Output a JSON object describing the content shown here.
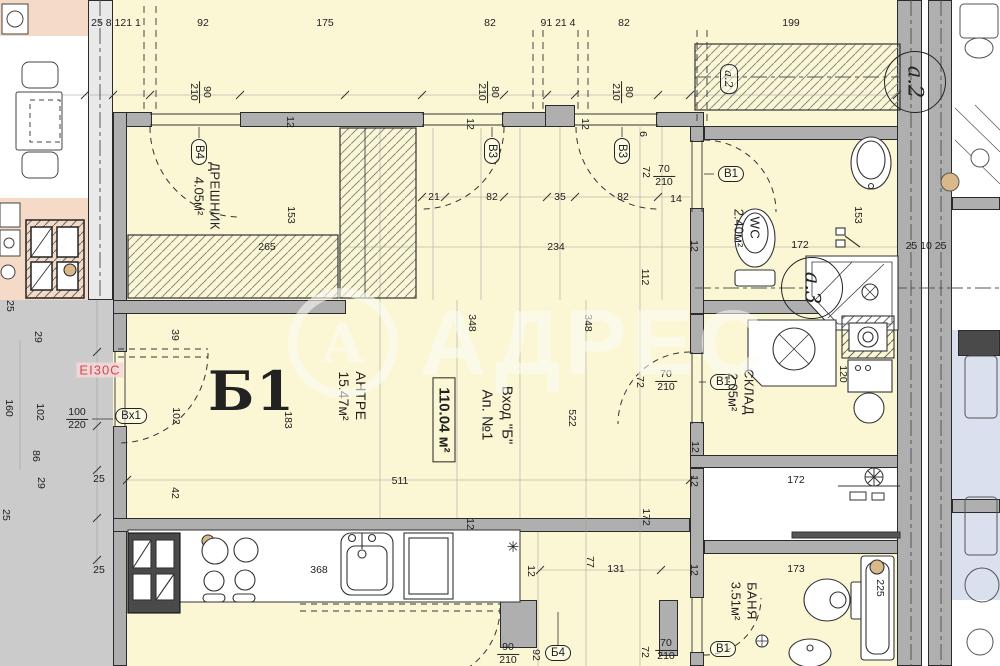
{
  "unit": {
    "label": "Б1",
    "area_box": "110.04 м²",
    "entrance_l1": "Вход \"Б\"",
    "entrance_l2": "Ап. №1"
  },
  "fire_door_label": "EI30C",
  "watermark": {
    "text": "АДРЕС",
    "logo": "А"
  },
  "colors": {
    "floor_cream": "#FBF7D5",
    "wall_gray": "#AFAFAF",
    "corridor_gray": "#CBCBCB",
    "neighbor_pink": "#F5DAC8",
    "neighbor_blue": "#DBE0EE",
    "fire_red": "#C94F4F",
    "watermark": "rgba(252,252,246,0.58)"
  },
  "rooms": [
    {
      "name": "ДРЕШНИК",
      "area": "4.05м²",
      "x": 207,
      "y": 196,
      "fs": 13
    },
    {
      "name": "АНТРЕ",
      "area": "15.47м²",
      "x": 352,
      "y": 396,
      "fs": 14
    },
    {
      "name": "WC",
      "area": "2.40м²",
      "x": 747,
      "y": 228,
      "fs": 13
    },
    {
      "name": "СКЛАД",
      "area": "2.05м²",
      "x": 741,
      "y": 392,
      "fs": 13
    },
    {
      "name": "БАНЯ",
      "area": "3.51м²",
      "x": 744,
      "y": 601,
      "fs": 13
    }
  ],
  "door_tags": [
    {
      "t": "В4",
      "x": 199,
      "y": 152,
      "rot": true
    },
    {
      "t": "В3",
      "x": 492,
      "y": 151,
      "rot": true
    },
    {
      "t": "В3",
      "x": 622,
      "y": 151,
      "rot": true
    },
    {
      "t": "В1",
      "x": 731,
      "y": 174
    },
    {
      "t": "В1",
      "x": 723,
      "y": 382
    },
    {
      "t": "Б4",
      "x": 558,
      "y": 653
    },
    {
      "t": "В1",
      "x": 723,
      "y": 649
    },
    {
      "t": "Вх1",
      "x": 131,
      "y": 416
    },
    {
      "t": "а.2",
      "x": 729,
      "y": 79,
      "rot": true,
      "it": true
    }
  ],
  "axes": [
    {
      "t": "а.2",
      "x": 915,
      "y": 82
    },
    {
      "t": "а.3",
      "x": 812,
      "y": 288
    }
  ],
  "door_sizes": [
    {
      "a": "90",
      "b": "210",
      "x": 200,
      "y": 92,
      "rot": true
    },
    {
      "a": "80",
      "b": "210",
      "x": 488,
      "y": 92,
      "rot": true
    },
    {
      "a": "80",
      "b": "210",
      "x": 622,
      "y": 92,
      "rot": true
    },
    {
      "a": "70",
      "b": "210",
      "x": 664,
      "y": 176
    },
    {
      "a": "70",
      "b": "210",
      "x": 666,
      "y": 381
    },
    {
      "a": "70",
      "b": "210",
      "x": 666,
      "y": 650
    },
    {
      "a": "90",
      "b": "210",
      "x": 508,
      "y": 654
    },
    {
      "a": "100",
      "b": "220",
      "x": 77,
      "y": 419
    }
  ],
  "dims": [
    {
      "t": "25 8 121 1",
      "x": 116,
      "y": 23
    },
    {
      "t": "92",
      "x": 203,
      "y": 23
    },
    {
      "t": "175",
      "x": 325,
      "y": 23
    },
    {
      "t": "82",
      "x": 490,
      "y": 23
    },
    {
      "t": "91 21 4",
      "x": 558,
      "y": 23
    },
    {
      "t": "82",
      "x": 624,
      "y": 23
    },
    {
      "t": "199",
      "x": 791,
      "y": 23
    },
    {
      "t": "21",
      "x": 434,
      "y": 197
    },
    {
      "t": "82",
      "x": 492,
      "y": 197
    },
    {
      "t": "35",
      "x": 560,
      "y": 197
    },
    {
      "t": "82",
      "x": 623,
      "y": 197
    },
    {
      "t": "234",
      "x": 556,
      "y": 247
    },
    {
      "t": "112",
      "x": 645,
      "y": 277,
      "r": true
    },
    {
      "t": "348",
      "x": 472,
      "y": 323,
      "r": true
    },
    {
      "t": "348",
      "x": 588,
      "y": 323,
      "r": true
    },
    {
      "t": "522",
      "x": 572,
      "y": 418,
      "r": true
    },
    {
      "t": "511",
      "x": 400,
      "y": 481
    },
    {
      "t": "183",
      "x": 288,
      "y": 420,
      "r": true
    },
    {
      "t": "39",
      "x": 175,
      "y": 335,
      "r": true
    },
    {
      "t": "102",
      "x": 176,
      "y": 416,
      "r": true
    },
    {
      "t": "153",
      "x": 291,
      "y": 215,
      "r": true
    },
    {
      "t": "265",
      "x": 267,
      "y": 247
    },
    {
      "t": "153",
      "x": 858,
      "y": 215,
      "r": true
    },
    {
      "t": "172",
      "x": 800,
      "y": 245
    },
    {
      "t": "120",
      "x": 843,
      "y": 374,
      "r": true
    },
    {
      "t": "172",
      "x": 796,
      "y": 480
    },
    {
      "t": "172",
      "x": 646,
      "y": 517,
      "r": true
    },
    {
      "t": "173",
      "x": 796,
      "y": 569
    },
    {
      "t": "225",
      "x": 880,
      "y": 588,
      "r": true
    },
    {
      "t": "25 10 25",
      "x": 926,
      "y": 246
    },
    {
      "t": "368",
      "x": 319,
      "y": 570
    },
    {
      "t": "131",
      "x": 616,
      "y": 569
    },
    {
      "t": "77",
      "x": 590,
      "y": 562,
      "r": true
    },
    {
      "t": "92",
      "x": 536,
      "y": 655,
      "r": true
    },
    {
      "t": "72",
      "x": 646,
      "y": 172,
      "r": true
    },
    {
      "t": "72",
      "x": 640,
      "y": 382,
      "r": true
    },
    {
      "t": "72",
      "x": 645,
      "y": 652,
      "r": true
    },
    {
      "t": "14",
      "x": 676,
      "y": 199
    },
    {
      "t": "6",
      "x": 643,
      "y": 134,
      "r": true
    },
    {
      "t": "25",
      "x": 10,
      "y": 306,
      "r": true
    },
    {
      "t": "29",
      "x": 38,
      "y": 337,
      "r": true
    },
    {
      "t": "160",
      "x": 9,
      "y": 408,
      "r": true
    },
    {
      "t": "102",
      "x": 40,
      "y": 412,
      "r": true
    },
    {
      "t": "86",
      "x": 36,
      "y": 456,
      "r": true
    },
    {
      "t": "29",
      "x": 41,
      "y": 483,
      "r": true
    },
    {
      "t": "25",
      "x": 99,
      "y": 479
    },
    {
      "t": "42",
      "x": 175,
      "y": 493,
      "r": true
    },
    {
      "t": "25",
      "x": 6,
      "y": 515,
      "r": true
    },
    {
      "t": "25",
      "x": 99,
      "y": 570
    },
    {
      "t": "12",
      "x": 290,
      "y": 122,
      "r": true
    },
    {
      "t": "12",
      "x": 470,
      "y": 124,
      "r": true
    },
    {
      "t": "12",
      "x": 585,
      "y": 124,
      "r": true
    },
    {
      "t": "12",
      "x": 694,
      "y": 246,
      "r": true
    },
    {
      "t": "12",
      "x": 695,
      "y": 447,
      "r": true
    },
    {
      "t": "12",
      "x": 694,
      "y": 481,
      "r": true
    },
    {
      "t": "12",
      "x": 694,
      "y": 570,
      "r": true
    },
    {
      "t": "12",
      "x": 470,
      "y": 524,
      "r": true
    },
    {
      "t": "12",
      "x": 531,
      "y": 571,
      "r": true
    }
  ]
}
